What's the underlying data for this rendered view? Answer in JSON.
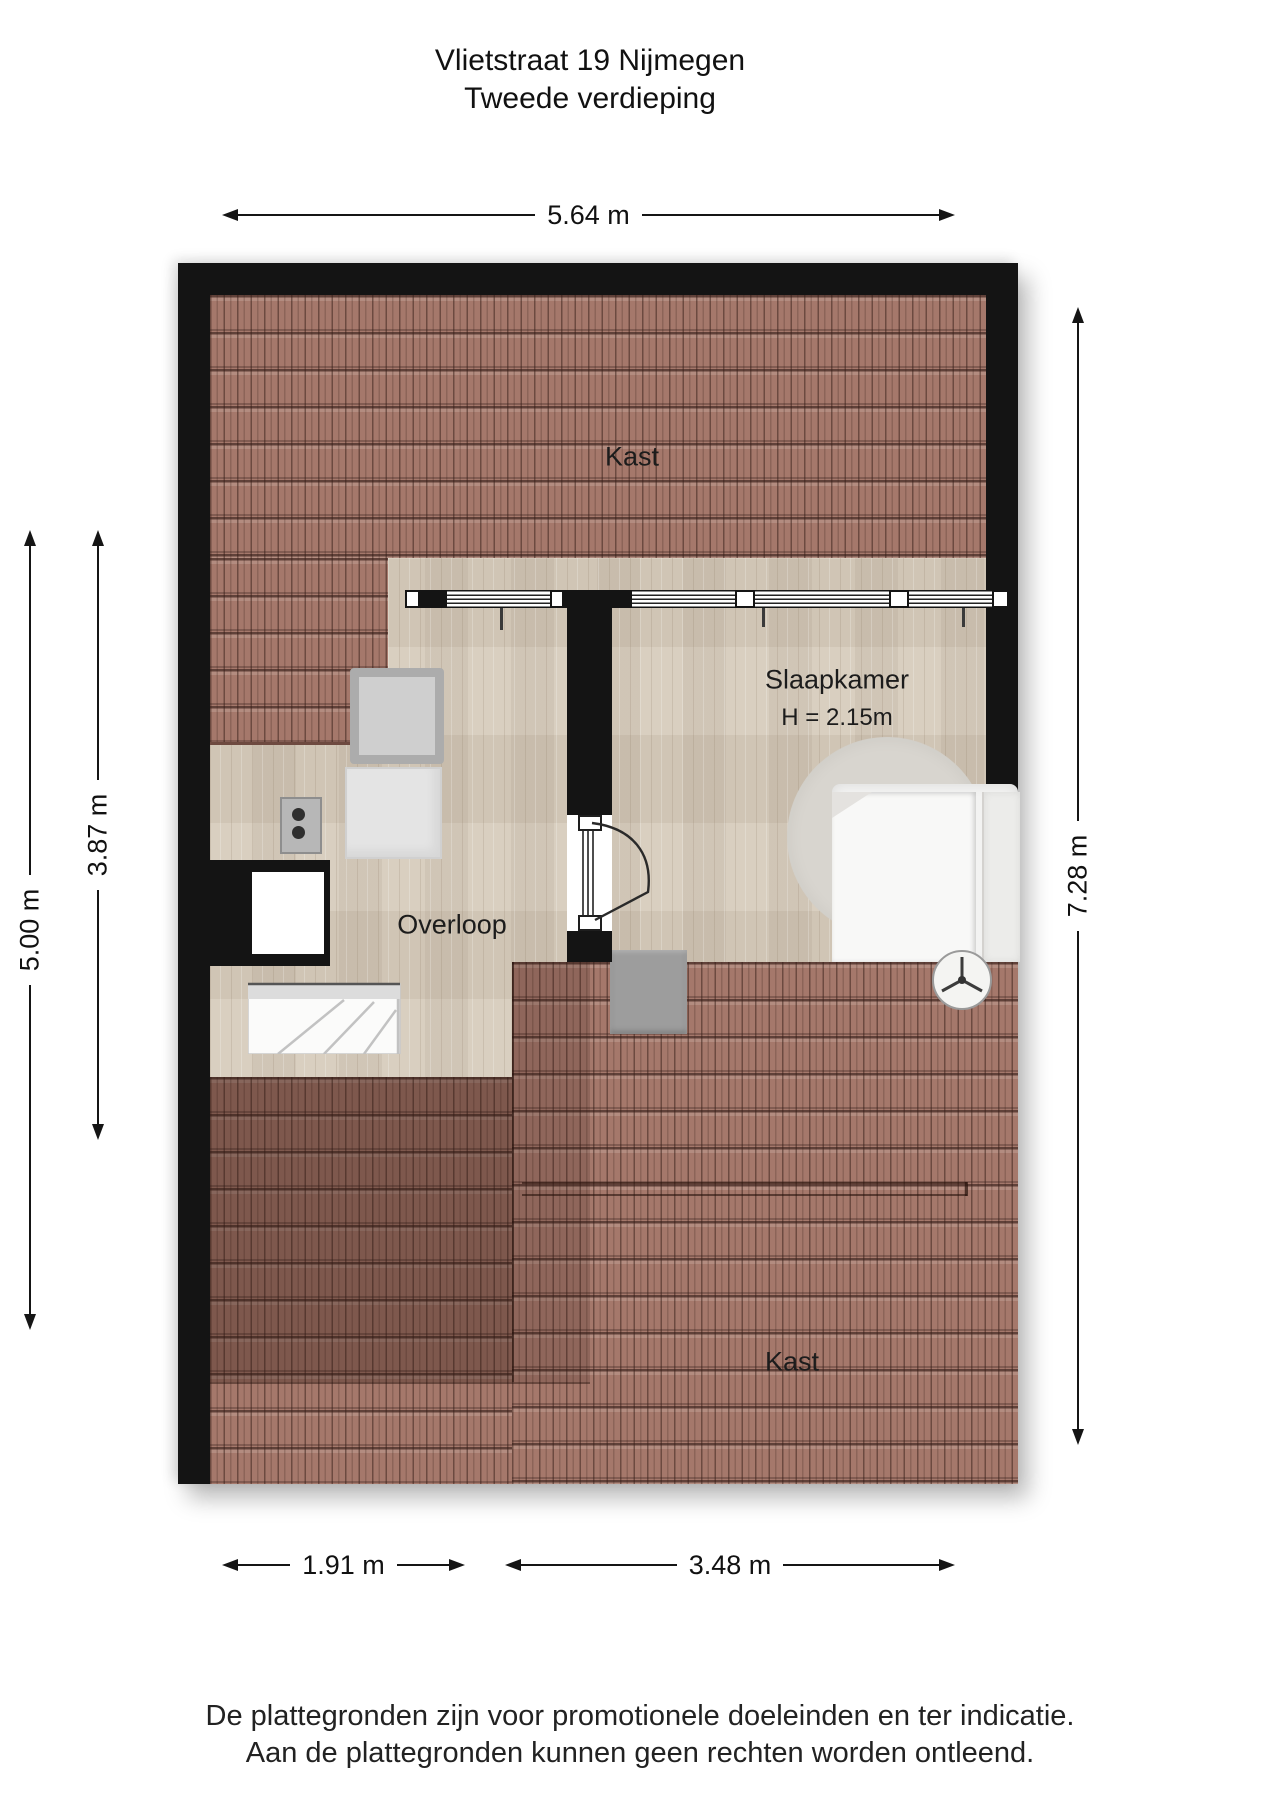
{
  "title": {
    "line1": "Vlietstraat 19 Nijmegen",
    "line2": "Tweede verdieping"
  },
  "rooms": {
    "kast_top": "Kast",
    "slaapkamer": "Slaapkamer",
    "slaapkamer_height": "H = 2.15m",
    "overloop": "Overloop",
    "kast_bottom": "Kast"
  },
  "dimensions": {
    "top": "5.64 m",
    "left_outer": "5.00 m",
    "left_inner": "3.87 m",
    "right": "7.28 m",
    "bottom_left": "1.91 m",
    "bottom_right": "3.48 m"
  },
  "disclaimer": {
    "line1": "De plattegronden zijn voor promotionele doeleinden en ter indicatie.",
    "line2": "Aan de plattegronden kunnen geen rechten worden ontleend."
  },
  "colors": {
    "wall": "#141414",
    "roof_tiles": "#a5786b",
    "wood_floor": "#d9cfc0",
    "furniture_gray": "#cfcfcf",
    "text": "#1a1a1a"
  }
}
